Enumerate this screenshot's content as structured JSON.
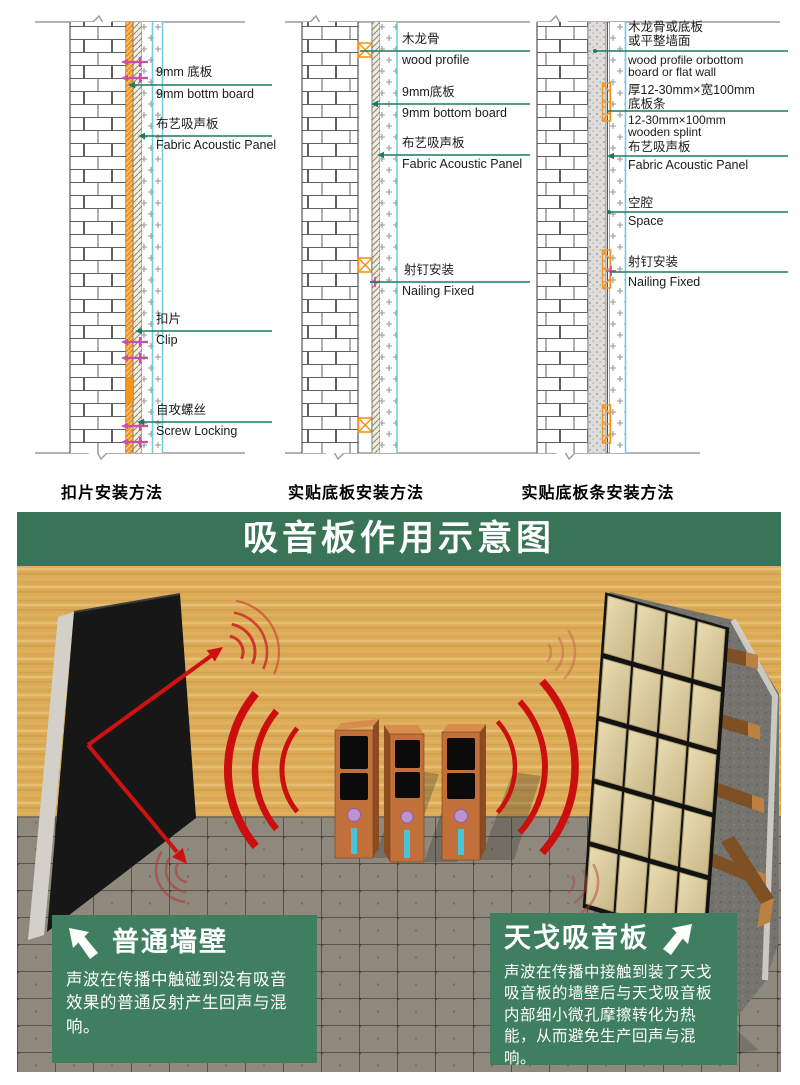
{
  "diagrams": {
    "d1": {
      "caption": "扣片安装方法",
      "l1zh": "9mm 底板",
      "l1en": "9mm bottm board",
      "l2zh": "布艺吸声板",
      "l2en": "Fabric Acoustic Panel",
      "l3zh": "扣片",
      "l3en": "Clip",
      "l4zh": "自攻螺丝",
      "l4en": "Screw Locking"
    },
    "d2": {
      "caption": "实贴底板安装方法",
      "l1zh": "木龙骨",
      "l1en": "wood profile",
      "l2zh": "9mm底板",
      "l2en": "9mm bottom board",
      "l3zh": "布艺吸声板",
      "l3en": "Fabric Acoustic Panel",
      "l4zh": "射钉安装",
      "l4en": "Nailing Fixed"
    },
    "d3": {
      "caption": "实贴底板条安装方法",
      "l1zh1": "木龙骨或底板",
      "l1zh2": "或平整墙面",
      "l1en1": "wood profile orbottom",
      "l1en2": "board or flat wall",
      "l2zh1": "厚12-30mm×宽100mm",
      "l2zh2": "底板条",
      "l2en1": "12-30mm×100mm",
      "l2en2": "wooden splint",
      "l3zh": "布艺吸声板",
      "l3en": "Fabric Acoustic Panel",
      "l4zh": "空腔",
      "l4en": "Space",
      "l5zh": "射钉安装",
      "l5en": "Nailing Fixed"
    }
  },
  "scene": {
    "title": "吸音板作用示意图",
    "left_box": {
      "title": "普通墙壁",
      "body": "声波在传播中触碰到没有吸音效果的普通反射产生回声与混响。"
    },
    "right_box": {
      "title": "天戈吸音板",
      "body": "声波在传播中接触到装了天戈吸音板的墙壁后与天戈吸音板内部细小微孔摩擦转化为热能，从而避免生产回声与混响。"
    }
  },
  "colors": {
    "band_green": "#3a7457",
    "box_green": "#3f7f60",
    "leader_teal": "#1b7c64",
    "orange": "#f6951d",
    "cyan": "#72cde2",
    "magenta": "#c94fa6",
    "red": "#cb0f0f",
    "wood": "#dcab58",
    "floor": "#8e897c"
  }
}
